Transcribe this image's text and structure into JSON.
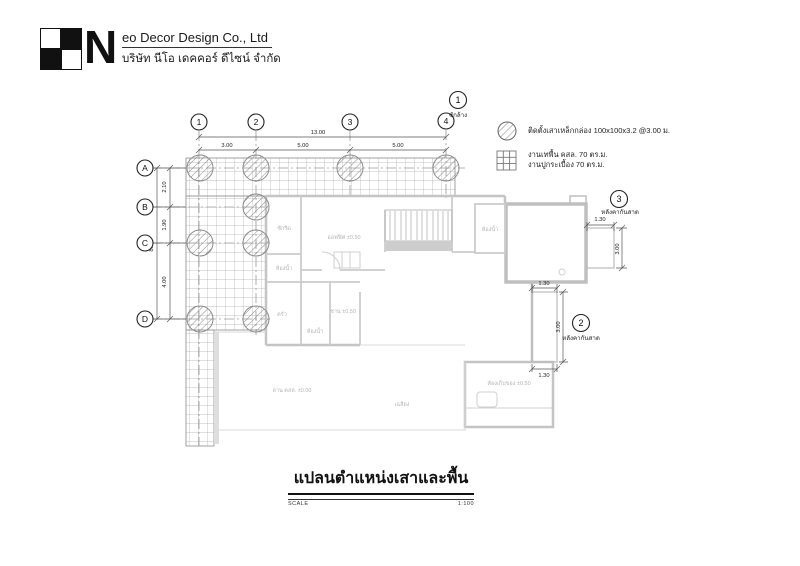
{
  "header": {
    "company_prefix": "N",
    "company_rest": "eo Decor Design Co., Ltd",
    "company_th": "บริษัท นีโอ เดคคอร์ ดีไซน์ จำกัด"
  },
  "legend": {
    "column_note": "ติดตั้งเสาเหล็กกล่อง 100x100x3.2 @3.00 ม.",
    "floor_note": "งานเทพื้น คสล. 70 ตร.ม.",
    "tile_note": "งานปูกระเบื้อง 70 ตร.ม."
  },
  "callouts": {
    "c1": {
      "number": "1",
      "label": "ซักล้าง"
    },
    "c2": {
      "number": "2",
      "label": "หลังคากันสาด"
    },
    "c3": {
      "number": "3",
      "label": "หลังคากันสาด"
    }
  },
  "grid": {
    "columns": [
      "1",
      "2",
      "3",
      "4"
    ],
    "rows": [
      "A",
      "B",
      "C",
      "D"
    ]
  },
  "dims": {
    "top_total": "13.00",
    "top_segments": [
      "3.00",
      "5.00",
      "5.00"
    ],
    "left_total": "8.00",
    "left_segments": [
      "2.10",
      "1.90",
      "4.00"
    ],
    "awning3": {
      "width": "1.30",
      "height": "3.00"
    },
    "awning2": {
      "width_top": "1.30",
      "width_bottom": "1.30",
      "height": "3.00"
    }
  },
  "rooms": [
    {
      "text": "ซักรีด"
    },
    {
      "text": "ห้องน้ำ"
    },
    {
      "text": "ครัว"
    },
    {
      "text": "ห้องน้ำ"
    },
    {
      "text": "ออฟฟิศ ±0.50"
    },
    {
      "text": "ห้องน้ำ"
    },
    {
      "text": "ชาน ±0.50"
    },
    {
      "text": "ลาน คสล. ±0.00"
    },
    {
      "text": "เฉลียง"
    },
    {
      "text": "ห้องเก็บของ ±0.50"
    }
  ],
  "title": {
    "text": "แปลนตำแหน่งเสาและพื้น",
    "scale_label": "SCALE",
    "scale_value": "1:100"
  },
  "colors": {
    "wall": "#c4c4c4",
    "tile_line": "#ababab",
    "dim_text": "#222222",
    "faint_label": "#b4b4b4"
  }
}
